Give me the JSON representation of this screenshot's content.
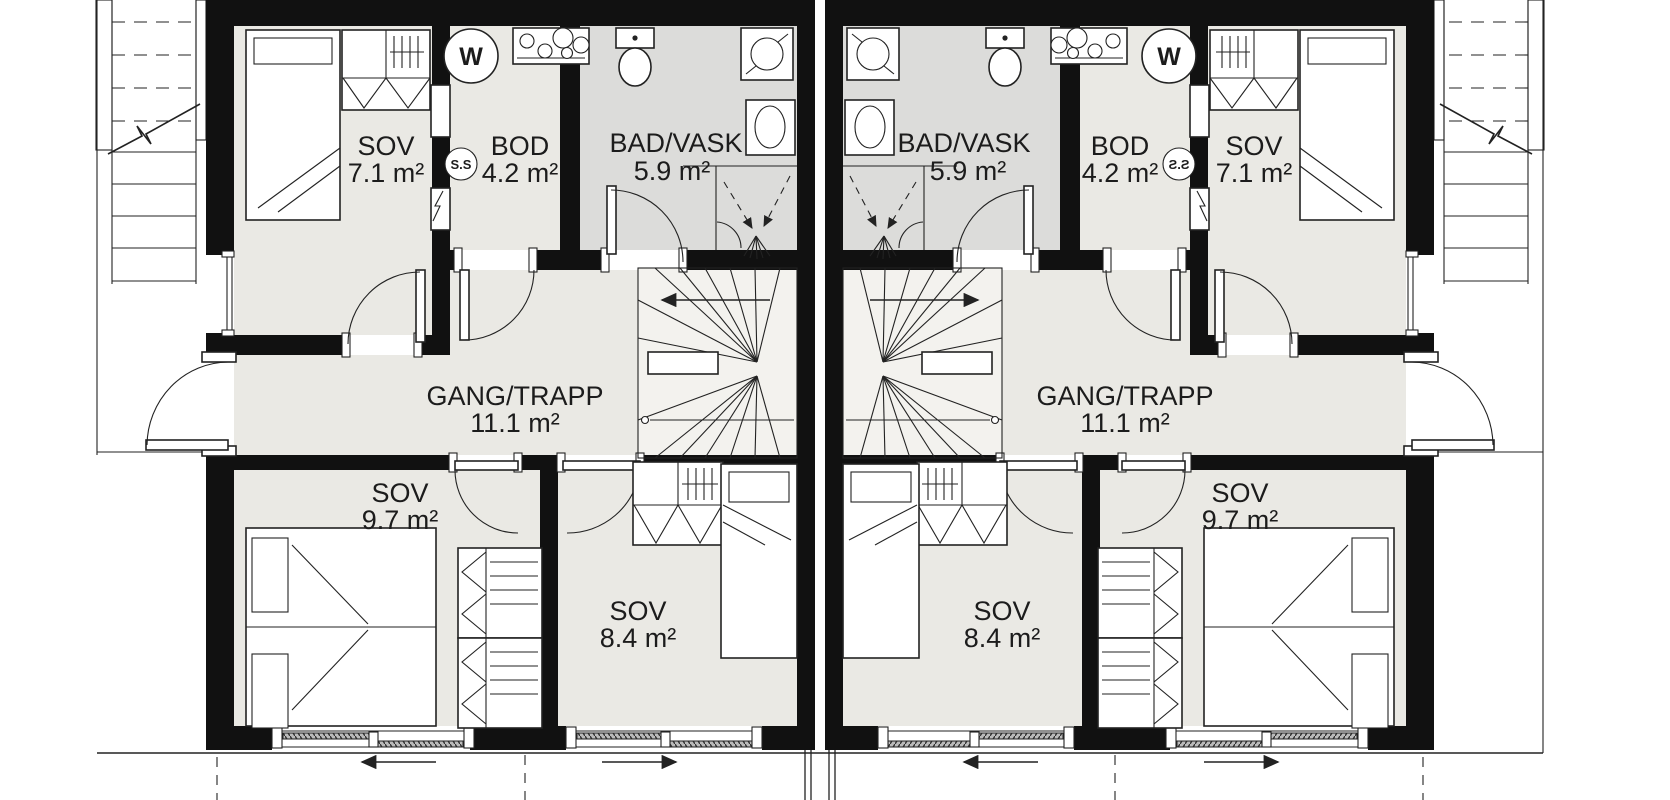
{
  "colors": {
    "wall": "#111111",
    "room": "#eae9e4",
    "bath": "#dcdcda",
    "stairfill": "#f3f2ee",
    "line": "#222222",
    "text": "#1c1c1c"
  },
  "units": [
    {
      "name": "left",
      "rooms": [
        {
          "key": "bedroom-top",
          "label": "SOV",
          "area": "7.1 m²"
        },
        {
          "key": "storage",
          "label": "BOD",
          "area": "4.2 m²"
        },
        {
          "key": "bathroom",
          "label": "BAD/VASK",
          "area": "5.9 m²"
        },
        {
          "key": "hall-stairs",
          "label": "GANG/TRAPP",
          "area": "11.1 m²"
        },
        {
          "key": "bedroom-west",
          "label": "SOV",
          "area": "9.7 m²"
        },
        {
          "key": "bedroom-center",
          "label": "SOV",
          "area": "8.4 m²"
        }
      ],
      "symbols": {
        "washing_machine": "W",
        "fuse_box": "S.S"
      }
    },
    {
      "name": "right",
      "rooms": [
        {
          "key": "bedroom-top",
          "label": "SOV",
          "area": "7.1 m²"
        },
        {
          "key": "storage",
          "label": "BOD",
          "area": "4.2 m²"
        },
        {
          "key": "bathroom",
          "label": "BAD/VASK",
          "area": "5.9 m²"
        },
        {
          "key": "hall-stairs",
          "label": "GANG/TRAPP",
          "area": "11.1 m²"
        },
        {
          "key": "bedroom-west",
          "label": "SOV",
          "area": "9.7 m²"
        },
        {
          "key": "bedroom-center",
          "label": "SOV",
          "area": "8.4 m²"
        }
      ],
      "symbols": {
        "washing_machine": "W",
        "fuse_box": "S.S"
      }
    }
  ]
}
